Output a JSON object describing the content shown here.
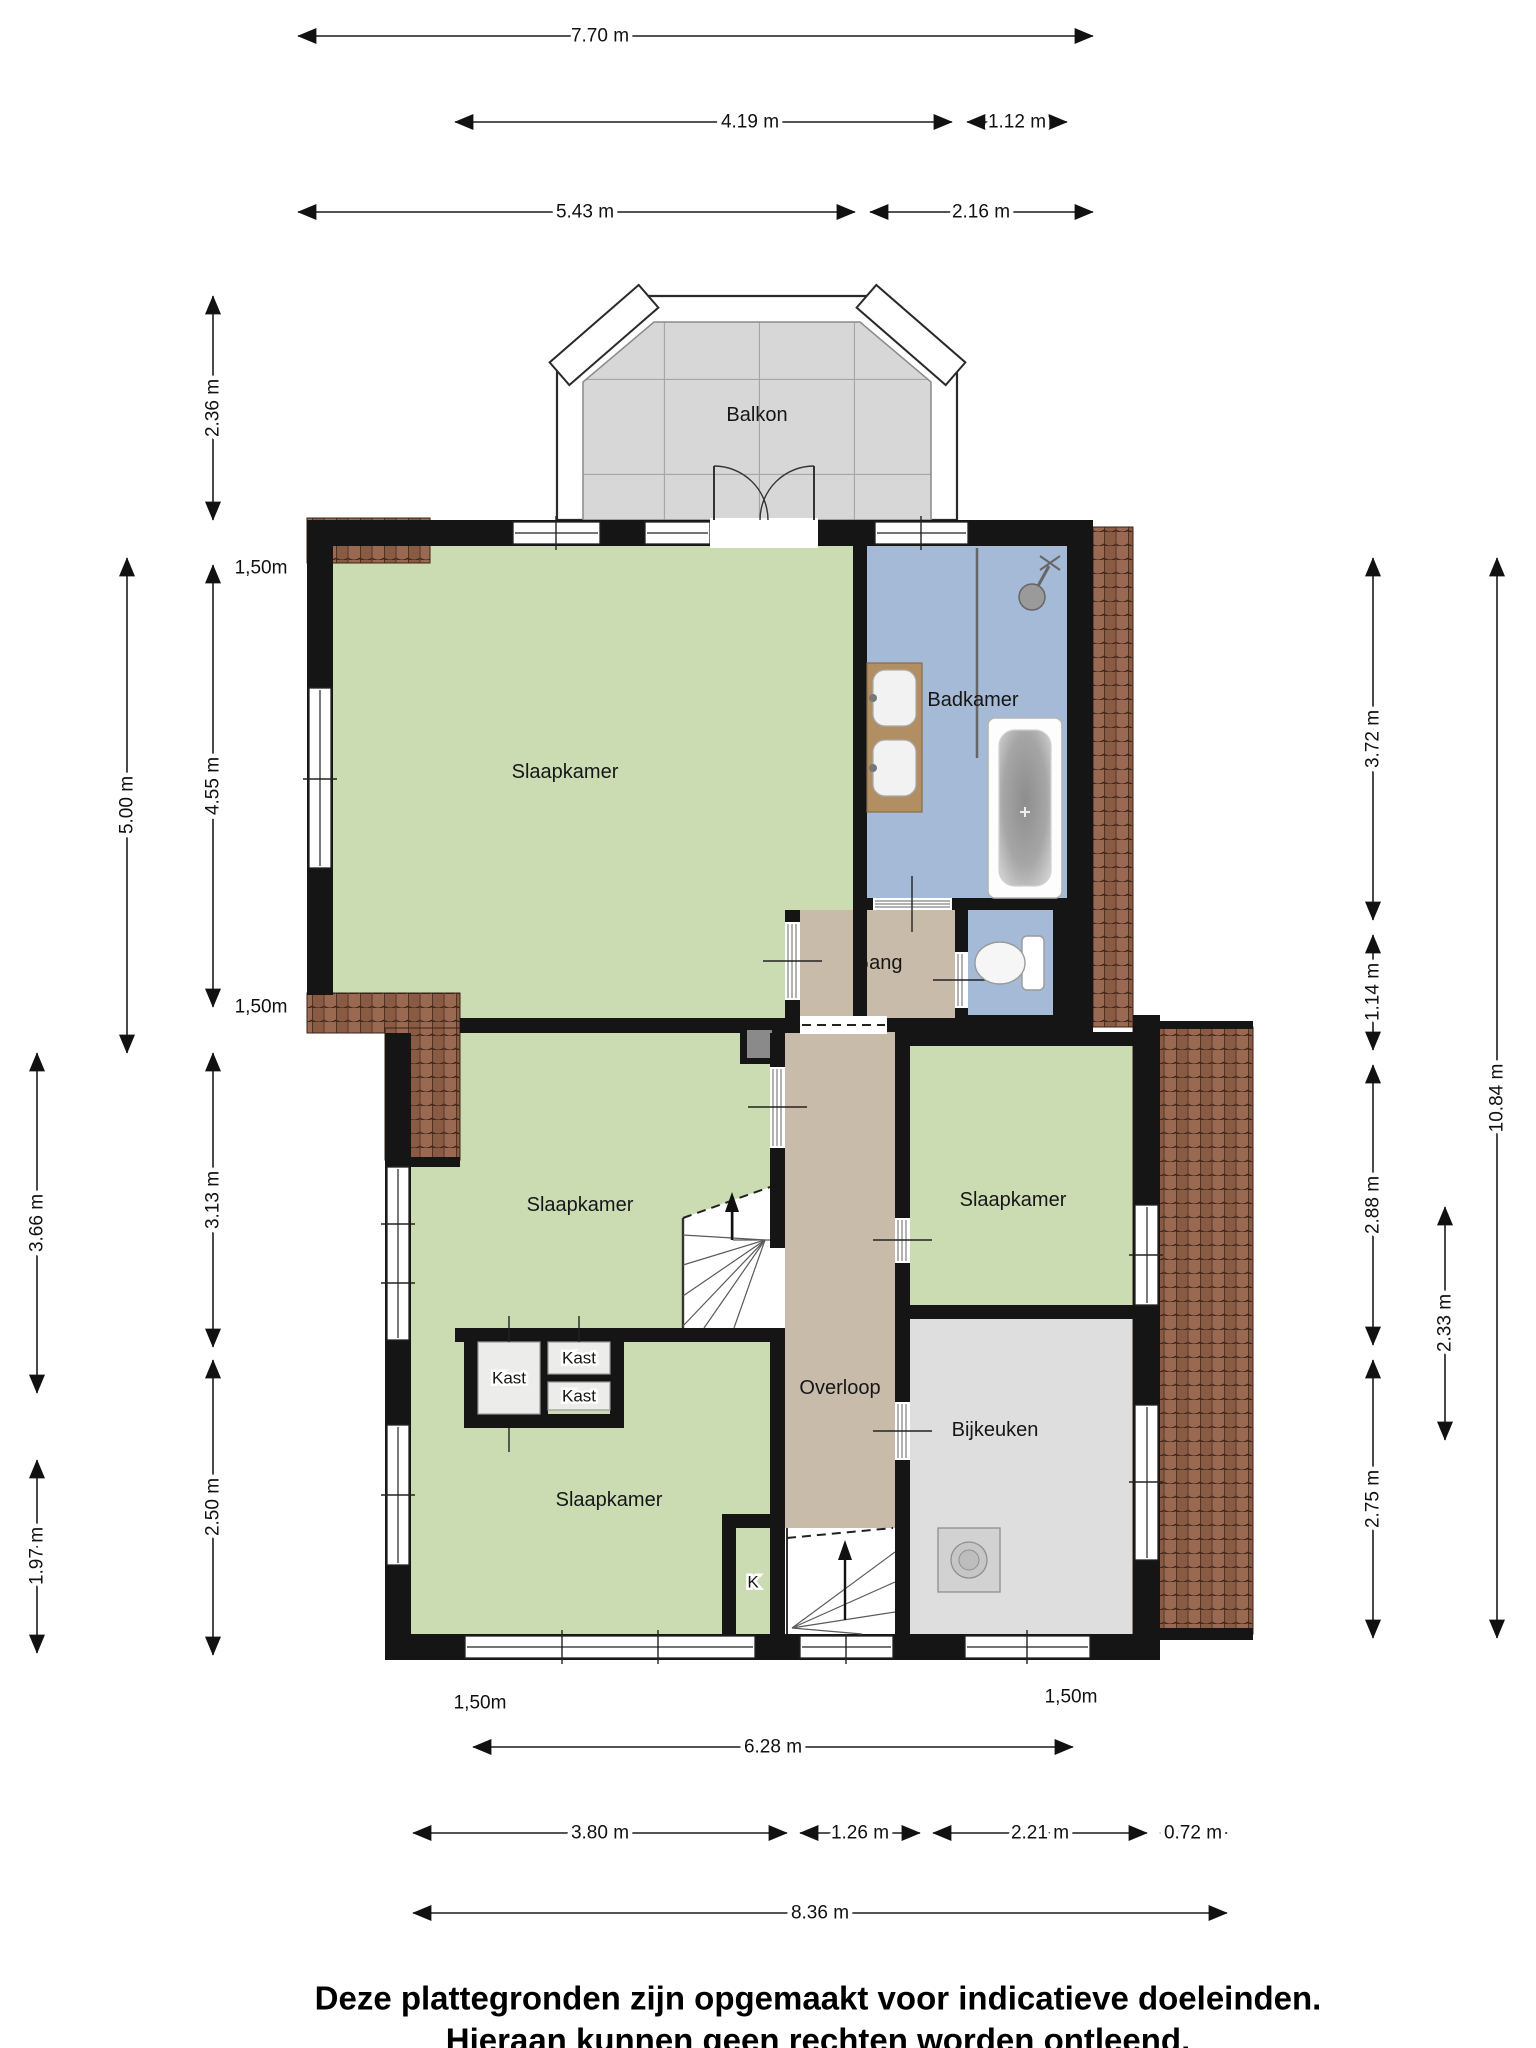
{
  "rooms": {
    "balkon": "Balkon",
    "slaapkamer": "Slaapkamer",
    "badkamer": "Badkamer",
    "gang": "Gang",
    "overloop": "Overloop",
    "bijkeuken": "Bijkeuken",
    "kast": "Kast",
    "k": "K"
  },
  "dims": {
    "d_7_70": "7.70 m",
    "d_4_19": "4.19 m",
    "d_1_12": "1.12 m",
    "d_5_43": "5.43 m",
    "d_2_16": "2.16 m",
    "d_2_36": "2.36 m",
    "d_5_00": "5.00 m",
    "d_4_55": "4.55 m",
    "d_1_50": "1,50m",
    "d_3_66": "3.66 m",
    "d_3_13": "3.13 m",
    "d_1_97": "1.97 m",
    "d_2_50": "2.50 m",
    "d_3_72": "3.72 m",
    "d_1_14": "1.14 m",
    "d_10_84": "10.84 m",
    "d_2_88": "2.88 m",
    "d_2_33": "2.33 m",
    "d_2_75": "2.75 m",
    "d_6_28": "6.28 m",
    "d_3_80": "3.80 m",
    "d_1_26": "1.26 m",
    "d_2_21": "2.21 m",
    "d_0_72": "0.72 m",
    "d_8_36": "8.36 m"
  },
  "footer": {
    "line1": "Deze plattegronden zijn opgemaakt voor indicatieve doeleinden.",
    "line2": "Hieraan kunnen geen rechten worden ontleend."
  },
  "colors": {
    "room_green": "#cbdcb2",
    "bath_blue": "#a4bad6",
    "hall_tan": "#c9bba9",
    "utility_gray": "#dedede",
    "balcony_gray": "#d7d7d7",
    "roof_tile": "#9a6850",
    "wall": "#151515"
  }
}
